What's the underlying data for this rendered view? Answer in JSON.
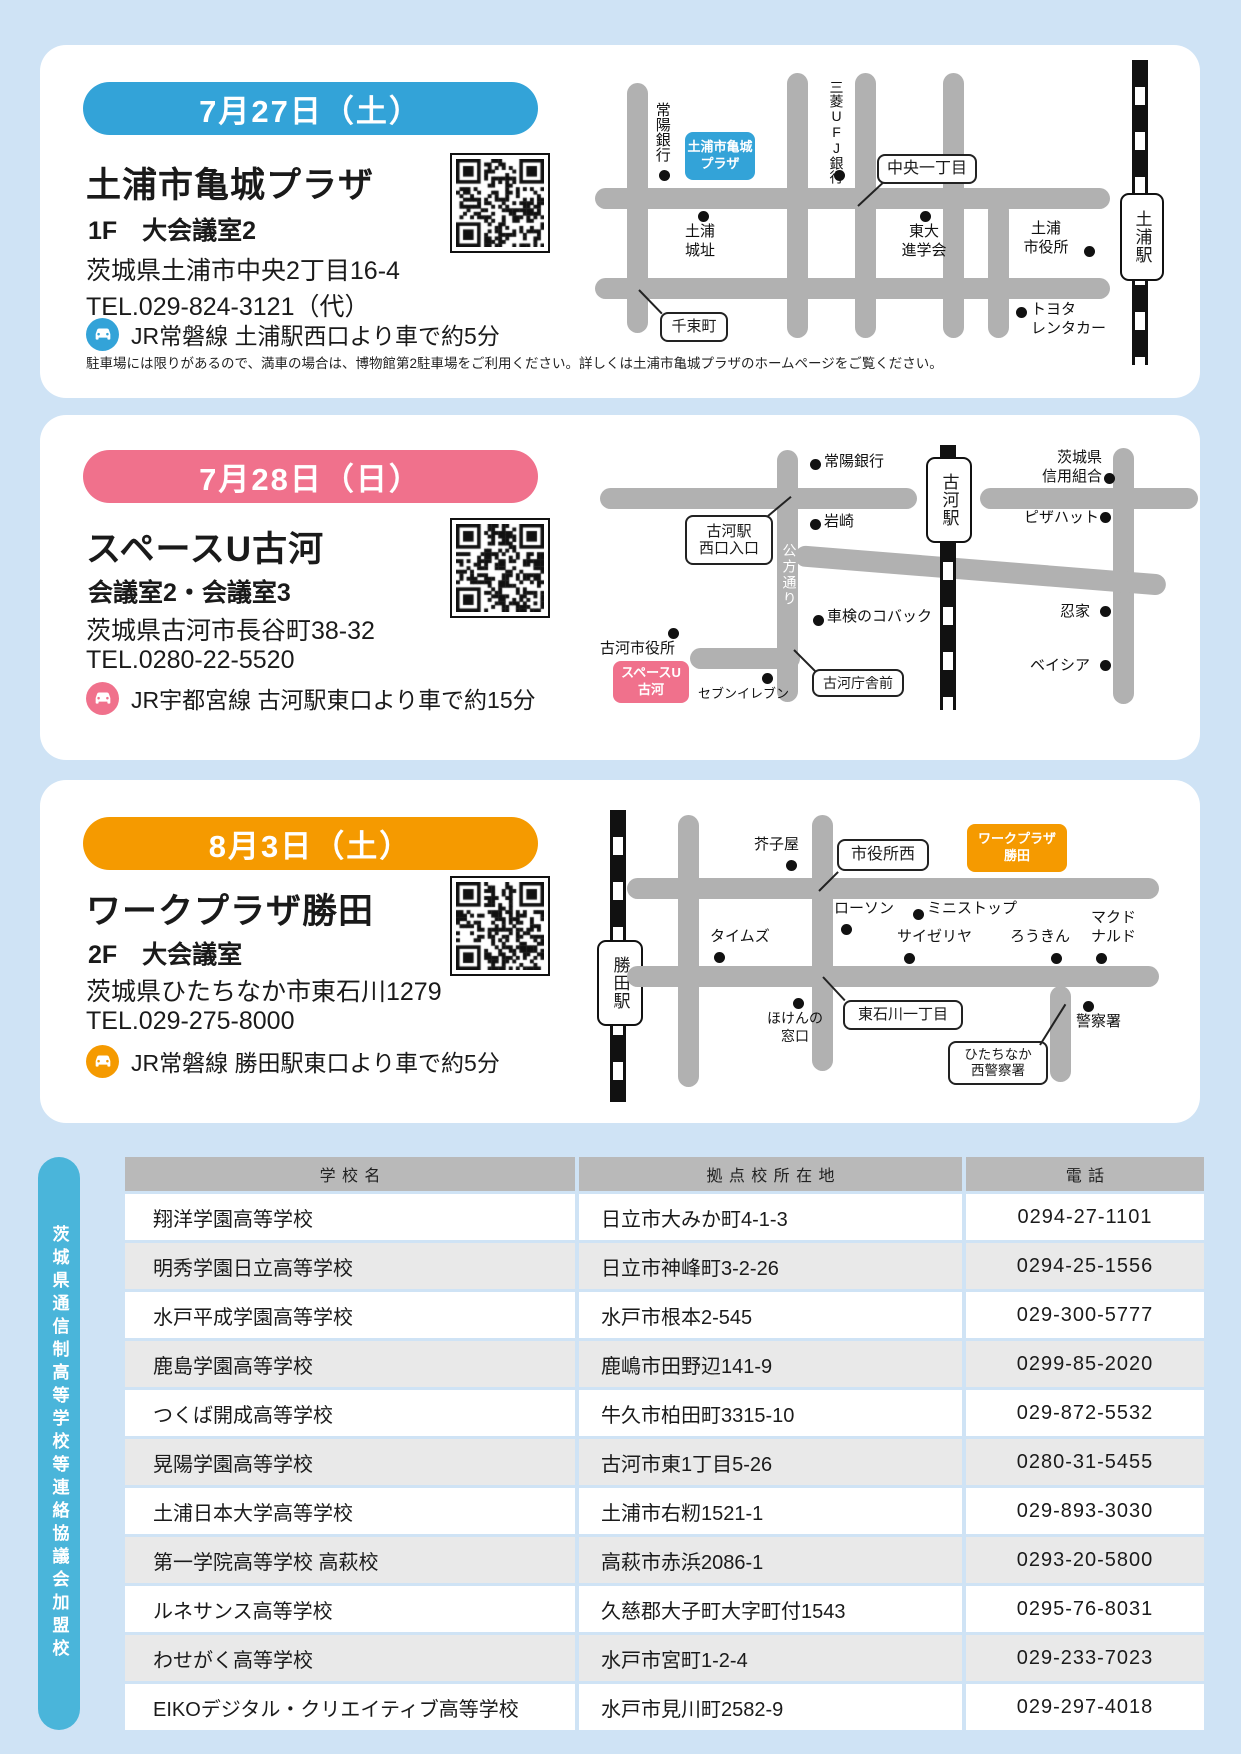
{
  "page_bg": "#cfe3f5",
  "cards": [
    {
      "date": "7月27日（土）",
      "venue": "土浦市亀城プラザ",
      "room": "1F　大会議室2",
      "address": "茨城県土浦市中央2丁目16-4",
      "tel": "TEL.029-824-3121（代）",
      "access": "JR常磐線 土浦駅西口より車で約5分",
      "note": "駐車場には限りがあるので、満車の場合は、博物館第2駐車場をご利用ください。詳しくは土浦市亀城プラザのホームページをご覧ください。",
      "accent": "#33a3d8",
      "map": {
        "station": "土浦駅",
        "venue_box": "土浦市亀城\nプラザ",
        "joyo_bank": "常陽銀行",
        "mitsubishi": "三菱UFJ銀行",
        "chuo_itchome": "中央一丁目",
        "tsuchiura_joshi": "土浦\n城址",
        "todai": "東大\n進学会",
        "shiyakusho": "土浦\n市役所",
        "toyota": "トヨタ\nレンタカー",
        "senzoku": "千束町"
      }
    },
    {
      "date": "7月28日（日）",
      "venue": "スペースU古河",
      "room": "会議室2・会議室3",
      "address": "茨城県古河市長谷町38-32",
      "tel": "TEL.0280-22-5520",
      "access": "JR宇都宮線 古河駅東口より車で約15分",
      "accent": "#f0718c",
      "map": {
        "station": "古河駅",
        "venue_box": "スペースU\n古河",
        "joyo_bank": "常陽銀行",
        "iwasaki": "岩崎",
        "nishiguchi": "古河駅\n西口入口",
        "kubo_dori": "公方通り",
        "kobac": "車検のコバック",
        "shiyakusho": "古河市役所",
        "seven": "セブンイレブン",
        "chosha_mae": "古河庁舎前",
        "shinyo": "茨城県\n信用組合",
        "pizza": "ピザハット",
        "shinobiya": "忍家",
        "beisia": "ベイシア"
      }
    },
    {
      "date": "8月3日（土）",
      "venue": "ワークプラザ勝田",
      "room": "2F　大会議室",
      "address": "茨城県ひたちなか市東石川1279",
      "tel": "TEL.029-275-8000",
      "access": "JR常磐線 勝田駅東口より車で約5分",
      "accent": "#f59a00",
      "map": {
        "station": "勝田駅",
        "venue_box": "ワークプラザ\n勝田",
        "karashiya": "芥子屋",
        "shiyakusho_nishi": "市役所西",
        "lawson": "ローソン",
        "ministop": "ミニストップ",
        "saizeriya": "サイゼリヤ",
        "rokin": "ろうきん",
        "times": "タイムズ",
        "mcdonalds": "マクド\nナルド",
        "hoken": "ほけんの\n窓口",
        "higashiishikawa": "東石川一丁目",
        "keisatsusho": "警察署",
        "nishi_keisatsu": "ひたちなか\n西警察署"
      }
    }
  ],
  "side_label": "茨城県通信制高等学校等連絡協議会加盟校",
  "table": {
    "headers": [
      "学校名",
      "拠点校所在地",
      "電話"
    ],
    "rows": [
      [
        "翔洋学園高等学校",
        "日立市大みか町4-1-3",
        "0294-27-1101"
      ],
      [
        "明秀学園日立高等学校",
        "日立市神峰町3-2-26",
        "0294-25-1556"
      ],
      [
        "水戸平成学園高等学校",
        "水戸市根本2-545",
        "029-300-5777"
      ],
      [
        "鹿島学園高等学校",
        "鹿嶋市田野辺141-9",
        "0299-85-2020"
      ],
      [
        "つくば開成高等学校",
        "牛久市柏田町3315-10",
        "029-872-5532"
      ],
      [
        "晃陽学園高等学校",
        "古河市東1丁目5-26",
        "0280-31-5455"
      ],
      [
        "土浦日本大学高等学校",
        "土浦市右籾1521-1",
        "029-893-3030"
      ],
      [
        "第一学院高等学校 高萩校",
        "高萩市赤浜2086-1",
        "0293-20-5800"
      ],
      [
        "ルネサンス高等学校",
        "久慈郡大子町大字町付1543",
        "0295-76-8031"
      ],
      [
        "わせがく高等学校",
        "水戸市宮町1-2-4",
        "029-233-7023"
      ],
      [
        "EIKOデジタル・クリエイティブ高等学校",
        "水戸市見川町2582-9",
        "029-297-4018"
      ]
    ]
  }
}
